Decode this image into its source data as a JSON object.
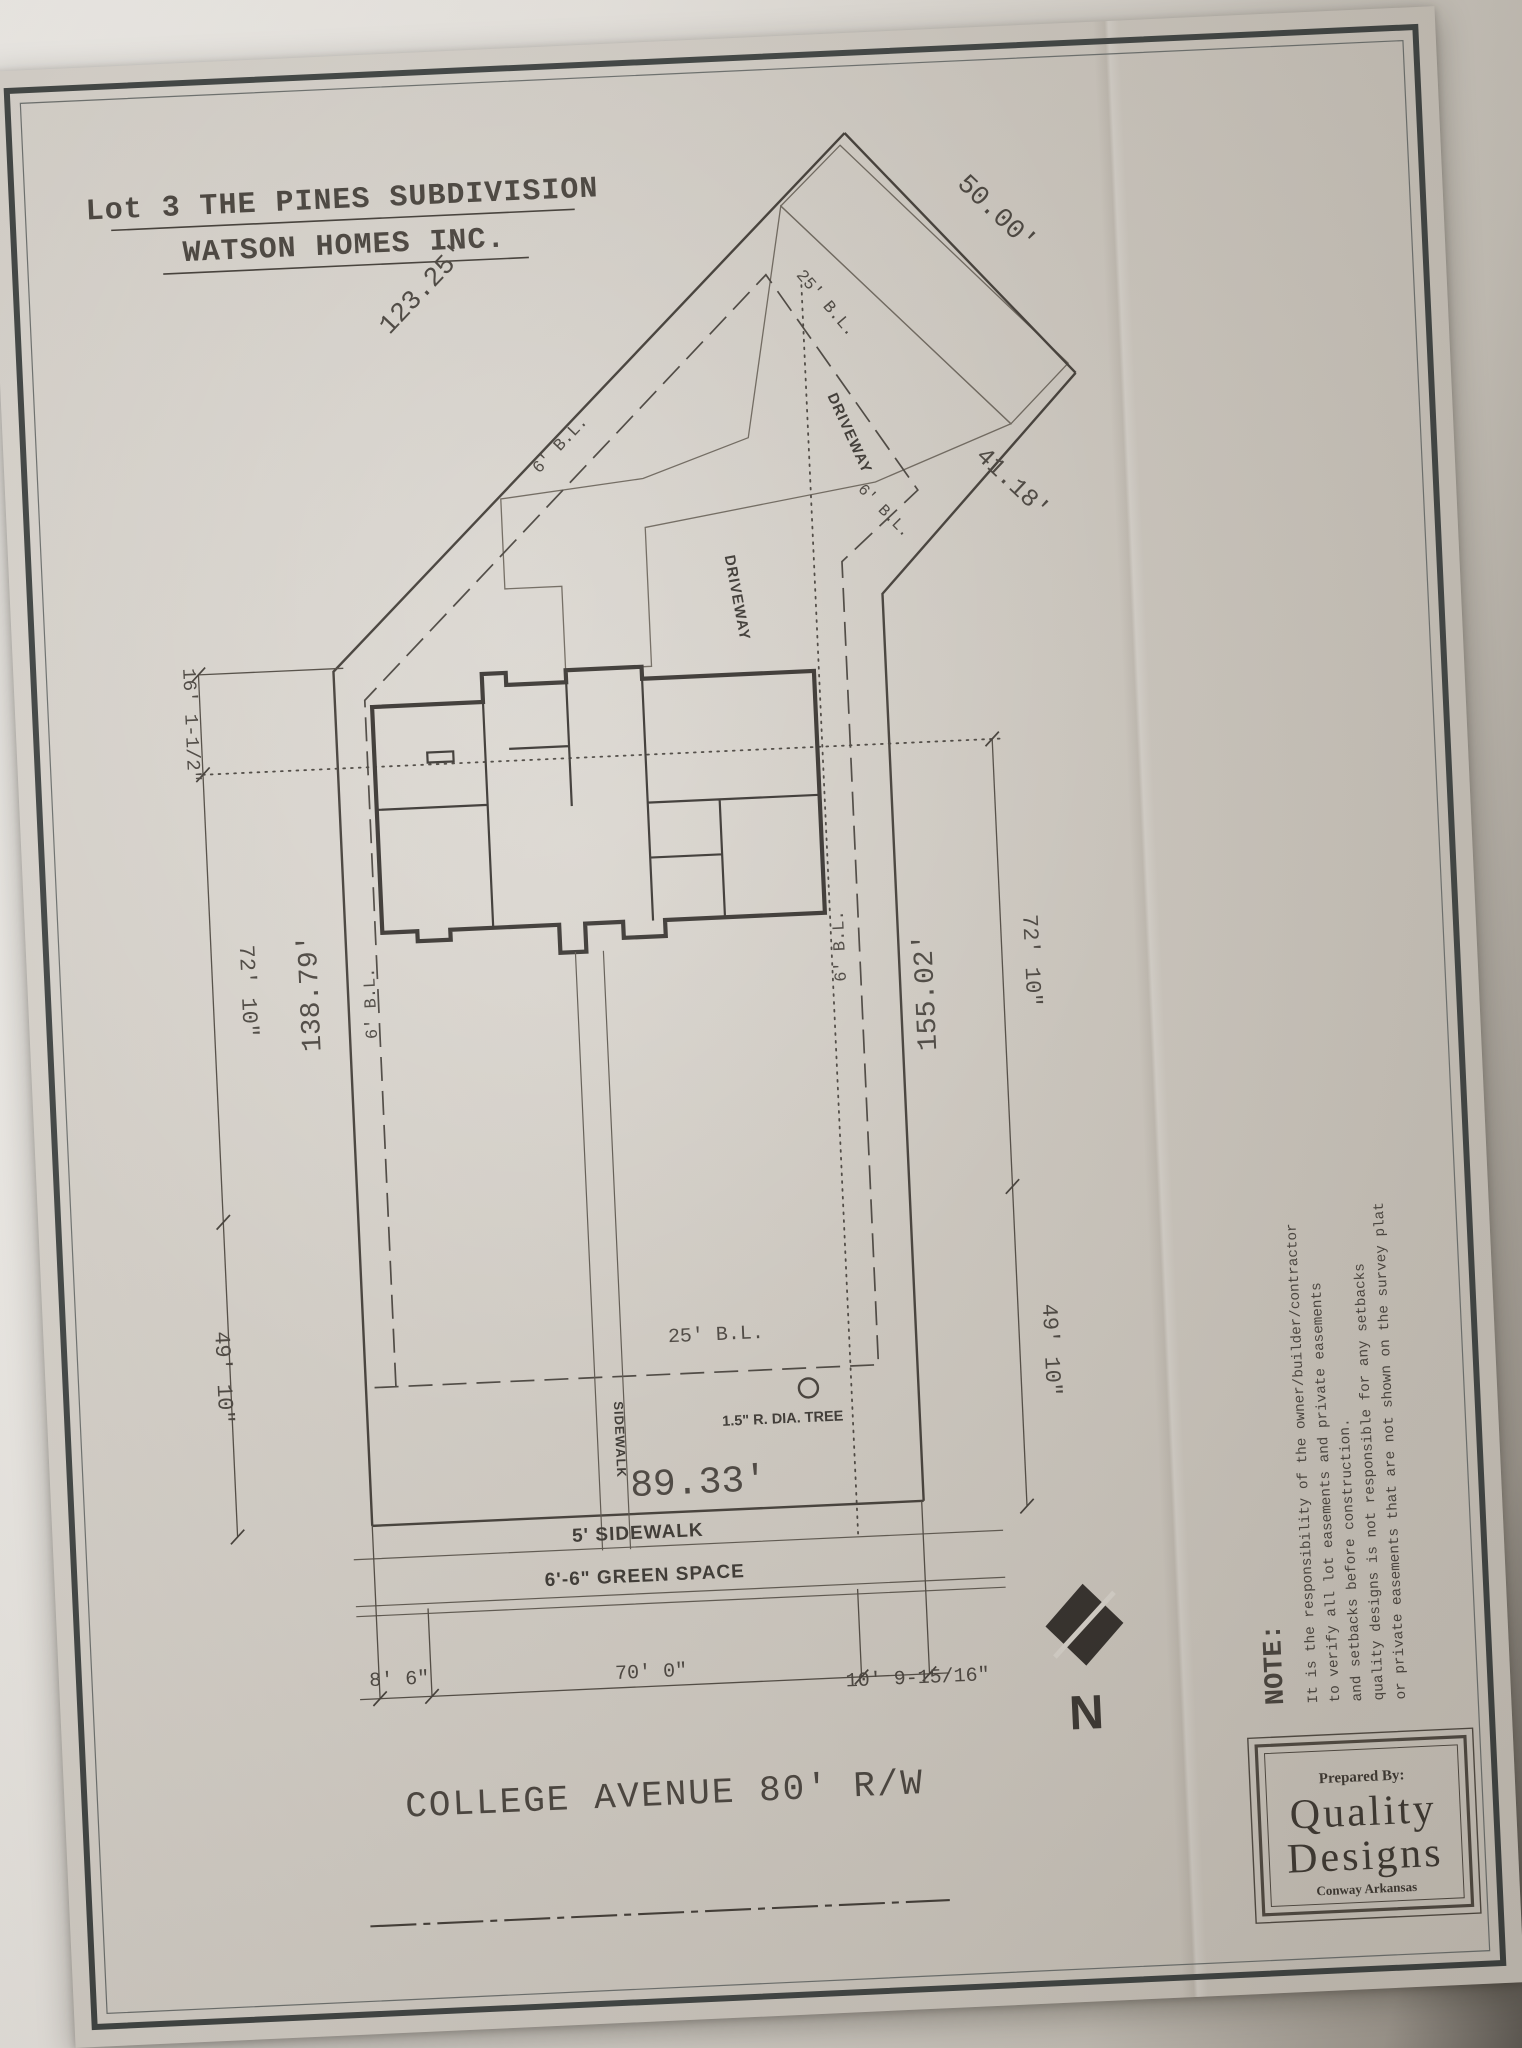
{
  "colors": {
    "paper": "#d7d2ca",
    "ink": "#3e3933",
    "dark": "#2e2a26"
  },
  "title": {
    "line1": "Lot 3 THE PINES SUBDIVISION",
    "line2": "WATSON HOMES INC."
  },
  "boundary": {
    "nw_edge": "123.25'",
    "ne_edge": "50.00'",
    "east_diagonal": "41.18'",
    "west_line": "138.79'",
    "east_line": "155.02'",
    "front": "89.33'"
  },
  "chain_dims": {
    "left_top": "16' 1-1/2\"",
    "left_mid": "72' 10\"",
    "left_bottom": "49' 10\"",
    "right_mid": "72' 10\"",
    "right_bottom": "49' 10\"",
    "street_left": "8' 6\"",
    "street_mid": "70' 0\"",
    "street_right": "10' 9-15/16\""
  },
  "setbacks": {
    "top_25": "25' B.L.",
    "front_25": "25' B.L.",
    "nw_6": "6' B.L.",
    "left_6": "6' B.L.",
    "right_upper_6": "6' B.L.",
    "right_mid_6": "6' B.L."
  },
  "site": {
    "driveway_upper": "DRIVEWAY",
    "driveway_lower": "DRIVEWAY",
    "front_walk": "SIDEWALK",
    "sidewalk_band": "5' SIDEWALK",
    "green_space_band": "6'-6\" GREEN SPACE",
    "tree": "1.5\" R. DIA. TREE",
    "street": "COLLEGE AVENUE 80' R/W",
    "north": "N"
  },
  "note": {
    "heading": "NOTE:",
    "lines": [
      "It is the responsibility of the owner/builder/contractor",
      "to verify all lot easements and private easements",
      "and setbacks before construction.",
      "quality designs is not responsible for any setbacks",
      "or private easements that are not shown on the survey plat"
    ]
  },
  "title_block": {
    "prepared_by": "Prepared By:",
    "firm_line1": "Quality",
    "firm_line2": "Designs",
    "location": "Conway Arkansas"
  }
}
